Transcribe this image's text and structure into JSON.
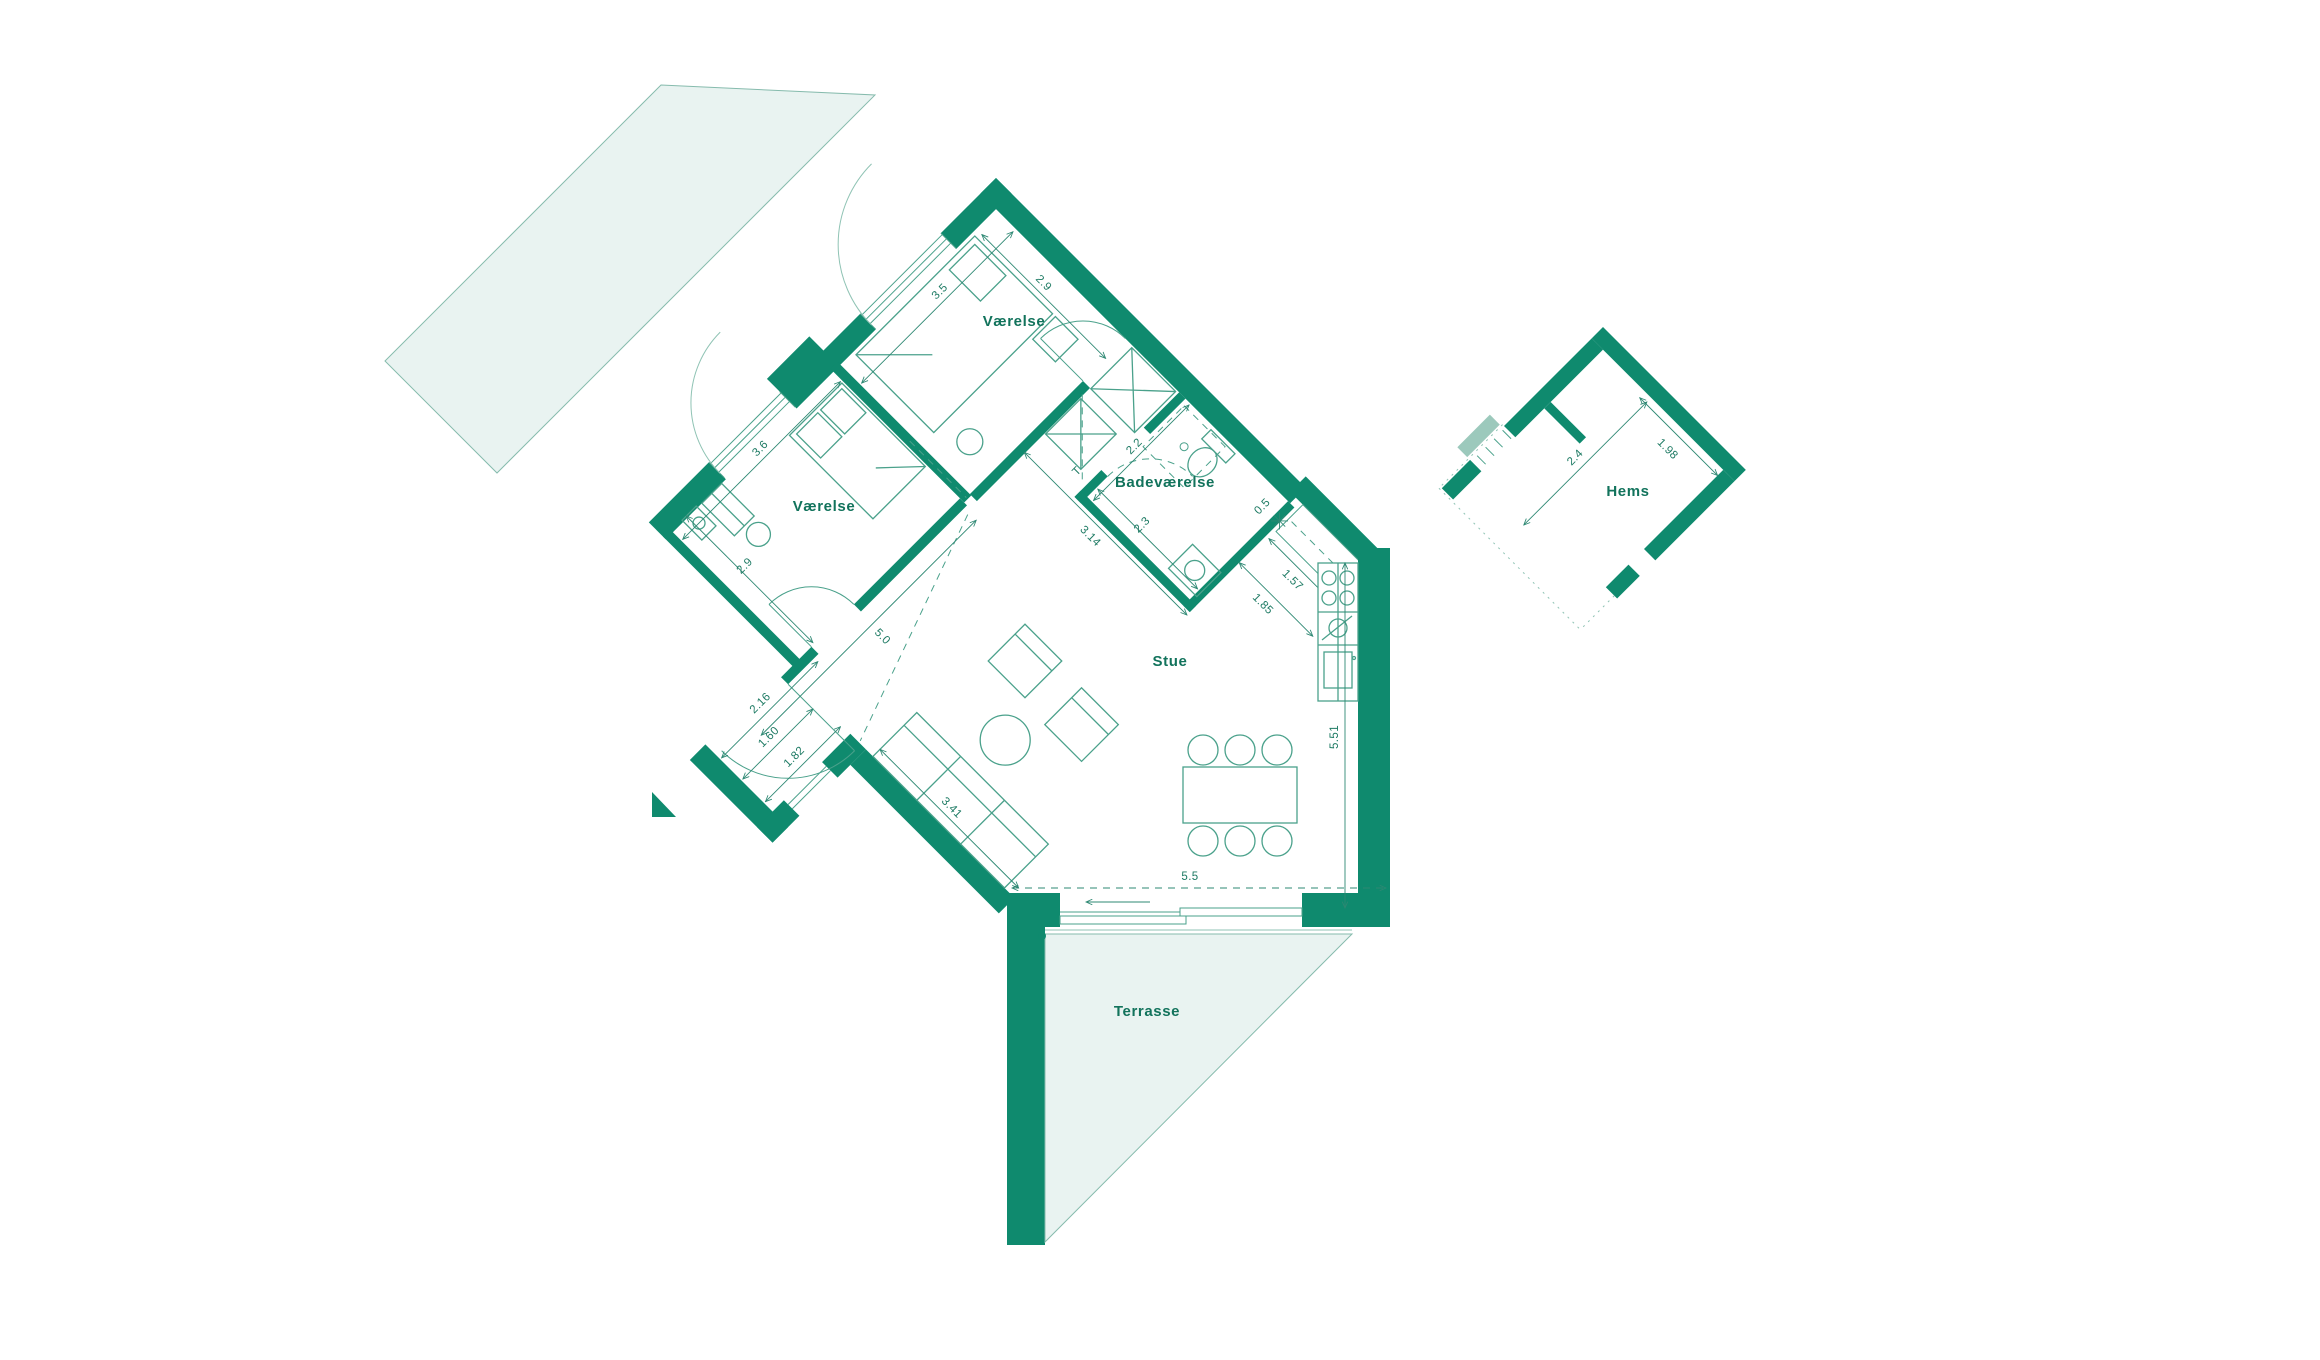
{
  "plan": {
    "rooms": {
      "top_bedroom": "Værelse",
      "left_bedroom": "Værelse",
      "bathroom": "Badeværelse",
      "living": "Stue",
      "terrace": "Terrasse",
      "loft": "Hems"
    },
    "dims": {
      "top_room_width": "2.9",
      "top_room_depth": "3.5",
      "left_room_depth": "3.6",
      "left_room_width": "2.9",
      "hall": "5.0",
      "entry_wall": "2.16",
      "entry_door": "1.60",
      "entry_side": "1.82",
      "sofa_wall": "3.41",
      "bath_depth": "2.2",
      "bath_width": "2.3",
      "hall_length": "3.14",
      "hall_to_kitchen": "1.85",
      "kitchen_niche": "0.5",
      "kitchen_wall": "1.57",
      "living_height": "5.51",
      "terrace_door": "5.5",
      "loft_depth": "2.4",
      "loft_width": "1.98"
    },
    "annotations": {
      "dryer": "T"
    },
    "colors": {
      "wall": "#0F8A6E",
      "line": "#4AA18B",
      "line_light": "#8FC3B4",
      "fill_light": "#E9F3F1",
      "text": "#12735C"
    }
  }
}
